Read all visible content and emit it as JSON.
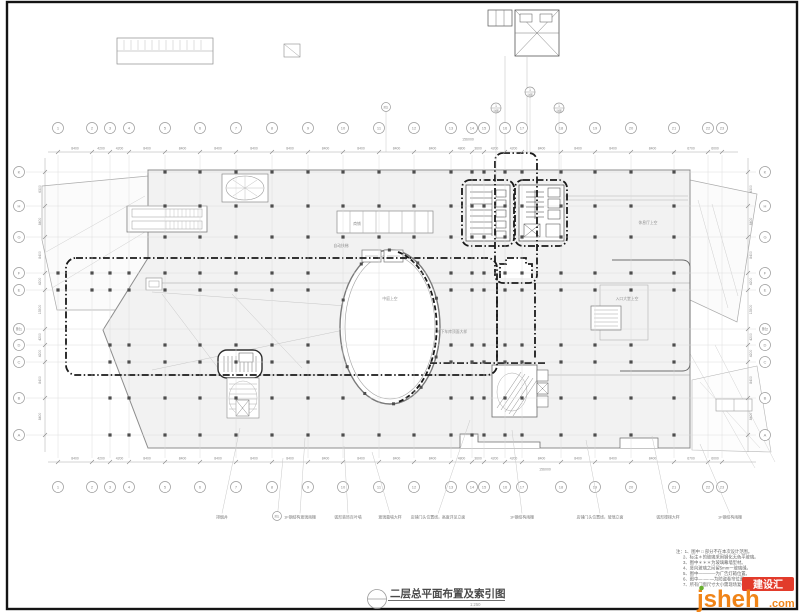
{
  "title_block": {
    "title": "二层总平面布置及索引图",
    "scale": "1:250"
  },
  "watermark": {
    "name": "jsheh",
    "tld": ".com",
    "badge": "建设汇"
  },
  "notes": {
    "lines": [
      "注：1、图中 □ 部分不在本次设计范围。",
      "2、标注＊的玻璃采用钢化无色平玻璃。",
      "3、图中＊＊＊为玻璃幕墙型材。",
      "4、竖向玻璃之间留5mm一玻璃缝。",
      "5、图中————为广告灯箱位置。",
      "6、图中—·—·—为防盗卷帘位置。",
      "7、所有门窗尺寸大小需现场复核后方可加工。"
    ]
  },
  "grid": {
    "cols": [
      {
        "label": "1",
        "x": 58
      },
      {
        "label": "2",
        "x": 92
      },
      {
        "label": "3",
        "x": 110
      },
      {
        "label": "4",
        "x": 129
      },
      {
        "label": "5",
        "x": 165
      },
      {
        "label": "6",
        "x": 200
      },
      {
        "label": "7",
        "x": 236
      },
      {
        "label": "8",
        "x": 272
      },
      {
        "label": "9",
        "x": 308
      },
      {
        "label": "10",
        "x": 343
      },
      {
        "label": "11",
        "x": 379
      },
      {
        "label": "12",
        "x": 414
      },
      {
        "label": "13",
        "x": 451
      },
      {
        "label": "14",
        "x": 472
      },
      {
        "label": "15",
        "x": 484
      },
      {
        "label": "16",
        "x": 505
      },
      {
        "label": "17",
        "x": 522
      },
      {
        "label": "18",
        "x": 561
      },
      {
        "label": "19",
        "x": 595
      },
      {
        "label": "20",
        "x": 631
      },
      {
        "label": "21",
        "x": 674
      },
      {
        "label": "22",
        "x": 708
      },
      {
        "label": "23",
        "x": 722
      }
    ],
    "top_dims": [
      "8400",
      "4200",
      "4200",
      "8400",
      "8400",
      "8400",
      "8400",
      "8400",
      "8400",
      "8400",
      "8400",
      "8400",
      "4800",
      "3600",
      "4200",
      "4200",
      "8400",
      "8400",
      "8400",
      "8400",
      "6700",
      "6000"
    ],
    "bottom_dims": [
      "8400",
      "4200",
      "4200",
      "8400",
      "8400",
      "8400",
      "8400",
      "8400",
      "8400",
      "8400",
      "8400",
      "8400",
      "4800",
      "3600",
      "4200",
      "4200",
      "8400",
      "8400",
      "8400",
      "8400",
      "6700",
      "6000"
    ],
    "total_label": "156000",
    "rows": [
      {
        "left": "K",
        "right": "K",
        "y": 172
      },
      {
        "left": "H",
        "right": "H",
        "y": 206
      },
      {
        "left": "G",
        "right": "G",
        "y": 237
      },
      {
        "left": "F",
        "right": "F",
        "y": 273
      },
      {
        "left": "E",
        "right": "E",
        "y": 290
      },
      {
        "left": "附1",
        "right": "附2",
        "y": 329
      },
      {
        "left": "D",
        "right": "D",
        "y": 345
      },
      {
        "left": "C",
        "right": "C",
        "y": 362
      },
      {
        "left": "B",
        "right": "B",
        "y": 398
      },
      {
        "left": "A",
        "right": "A",
        "y": 435
      }
    ],
    "row_dims": [
      "6300",
      "8400",
      "8400",
      "4200",
      "13500",
      "4200",
      "4200",
      "8400",
      "8400"
    ]
  },
  "plan": {
    "room_labels": [
      {
        "text": "商铺",
        "x": 357,
        "y": 225
      },
      {
        "text": "自动扶梯",
        "x": 341,
        "y": 247
      },
      {
        "text": "休息厅上空",
        "x": 648,
        "y": 224
      },
      {
        "text": "中庭上空",
        "x": 390,
        "y": 300
      },
      {
        "text": "入口大堂上空",
        "x": 627,
        "y": 300
      },
      {
        "text": "地下车库顶面大样",
        "x": 452,
        "y": 333
      }
    ],
    "bottom_labels": [
      {
        "text": "排烟井",
        "x": 222,
        "lx": 240,
        "ly": 428
      },
      {
        "text": "1F钢结构玻璃雨棚",
        "x": 300,
        "lx": 305,
        "ly": 438
      },
      {
        "text": "弧形装饰百叶墙",
        "x": 348,
        "lx": 344,
        "ly": 446
      },
      {
        "text": "玻璃幕墙大样",
        "x": 390,
        "lx": 372,
        "ly": 452
      },
      {
        "text": "店铺门头位置线，高度详见立面",
        "x": 438,
        "lx": 470,
        "ly": 420
      },
      {
        "text": "1F钢结构雨棚",
        "x": 522,
        "lx": 512,
        "ly": 430
      },
      {
        "text": "店铺门头位置线，玻璃立面",
        "x": 600,
        "lx": 586,
        "ly": 440
      },
      {
        "text": "弧形楼梯大样",
        "x": 668,
        "lx": 652,
        "ly": 436
      },
      {
        "text": "1F钢结构雨棚",
        "x": 730,
        "lx": 700,
        "ly": 444
      }
    ],
    "detail_callouts": [
      {
        "label": "1",
        "sub": "详图",
        "x": 530,
        "y": 92,
        "ly": 152
      },
      {
        "label": "1",
        "sub": "详图",
        "x": 496,
        "y": 108,
        "ly": 180
      },
      {
        "label": "1",
        "sub": "详图",
        "x": 559,
        "y": 108,
        "ly": 180
      }
    ],
    "aux_bubble_top": {
      "label": "附2",
      "x": 386,
      "y": 107,
      "lx": 386,
      "ly": 152
    },
    "aux_bubble_bottom": {
      "label": "附1",
      "x": 277,
      "y": 516,
      "lx": 283,
      "ly": 458
    }
  },
  "colors": {
    "paper": "#ffffff",
    "frame": "#141414",
    "grid_line": "#dadada",
    "axis": "#a8a8a8",
    "bubble_stroke": "#9a9a9a",
    "bubble_text": "#8a8a8a",
    "dim_text": "#8a8a8a",
    "wall": "#6d6d6d",
    "mass_fill": "#f2f2f2",
    "column": "#4d4d4d",
    "index_dash": "#1a1a1a",
    "label": "#8f8f8f",
    "leader": "#c8c8c8",
    "note_text": "#666666",
    "title_text": "#4a4a4a",
    "wm_orange": "#f08418",
    "wm_red": "#e23b2b",
    "wm_green": "#68b02f"
  }
}
